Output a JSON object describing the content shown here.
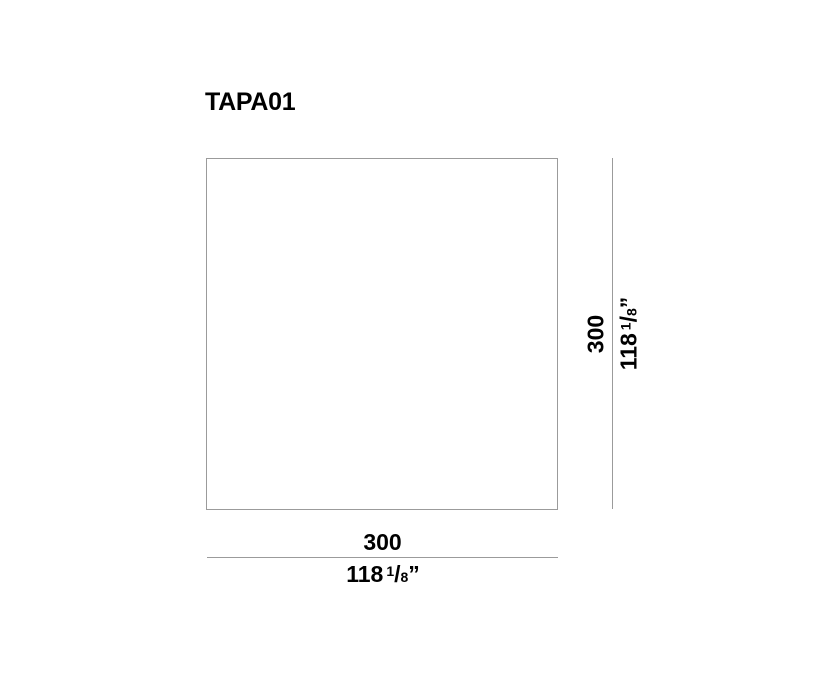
{
  "title": "TAPA01",
  "dimensions": {
    "horizontal": {
      "mm": "300",
      "inch_whole": "118",
      "inch_num": "1",
      "inch_slash": "/",
      "inch_den": "8",
      "inch_unit": "”"
    },
    "vertical": {
      "mm": "300",
      "inch_whole": "118",
      "inch_num": "1",
      "inch_slash": "/",
      "inch_den": "8",
      "inch_unit": "”"
    }
  },
  "colors": {
    "line_gray": "#9b9b9b",
    "text_black": "#000000",
    "background": "#ffffff"
  }
}
